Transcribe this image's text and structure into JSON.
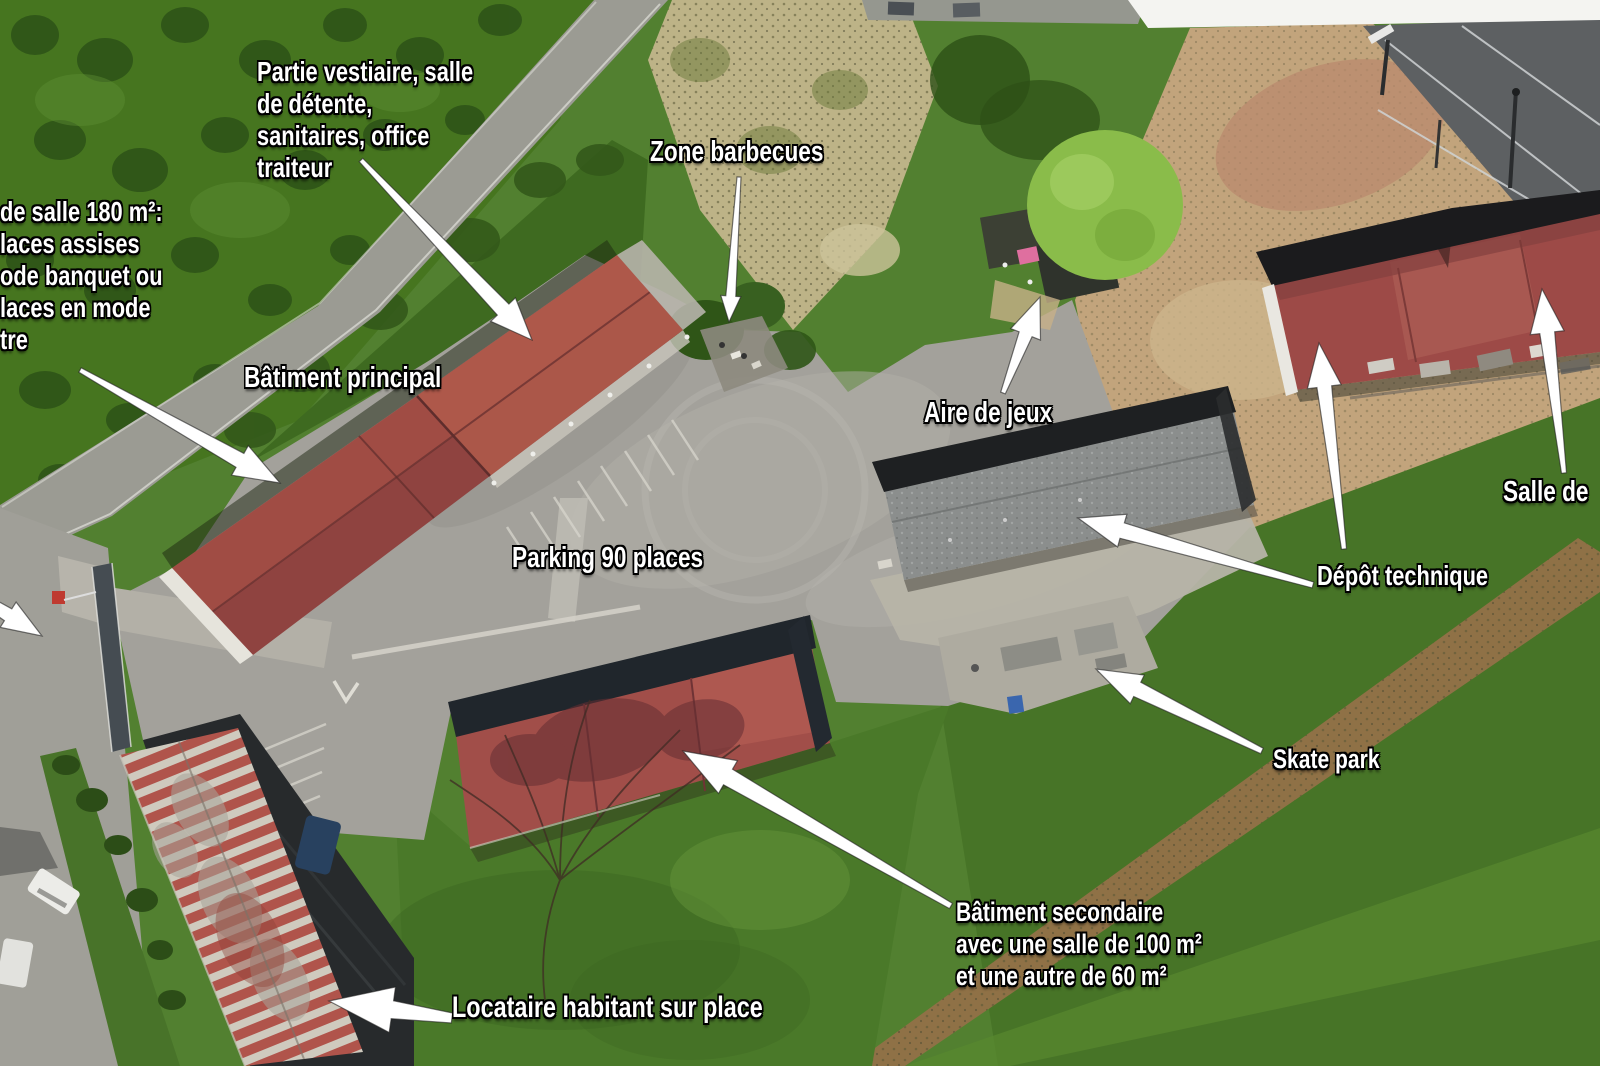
{
  "annotations": {
    "vestiaire": {
      "lines": [
        "Partie vestiaire, salle",
        "de détente,",
        "sanitaires, office",
        "traiteur"
      ]
    },
    "salle_info": {
      "lines": [
        "de salle 180 m²:",
        "laces assises",
        "ode banquet ou",
        "laces en mode",
        "tre"
      ]
    },
    "zone_barbecues": "Zone barbecues",
    "batiment_principal": "Bâtiment principal",
    "aire_de_jeux": "Aire de jeux",
    "parking": "Parking 90 places",
    "depot_technique": "Dépôt technique",
    "salle_de": "Salle de",
    "skate_park": "Skate park",
    "batiment_secondaire": {
      "lines": [
        "Bâtiment secondaire",
        "avec une salle de 100 m²",
        "et une autre de 60 m²"
      ]
    },
    "locataire": "Locataire habitant sur place"
  },
  "colors": {
    "label_text": "#ffffff",
    "label_outline": "#000000",
    "arrow": "#ffffff",
    "grass": "#528030",
    "roof_red": "#9d4a47",
    "roof_maroon": "#8f4340",
    "slate_roof": "#8b8e8d",
    "parking_asphalt": "#a3a19b",
    "dirt_tan": "#c2a47c"
  }
}
